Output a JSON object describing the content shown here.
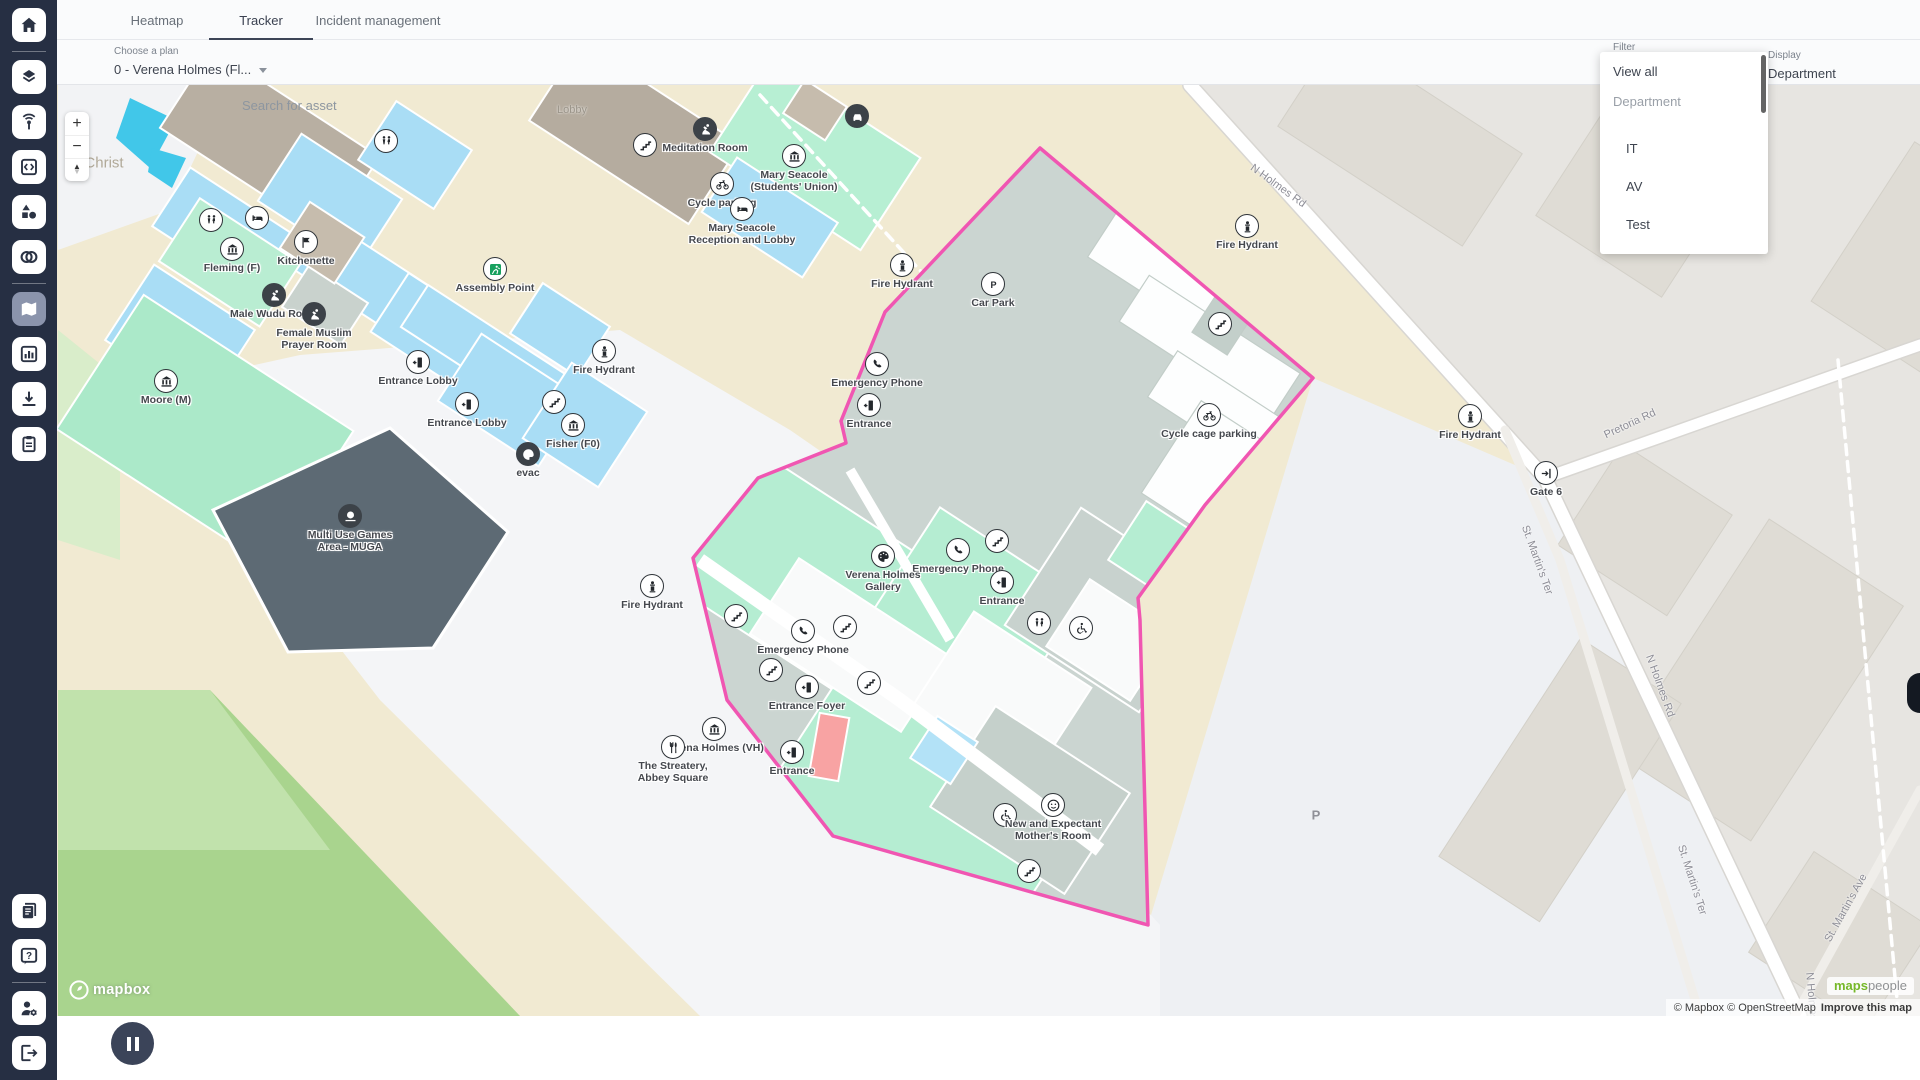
{
  "colors": {
    "accent_pink": "#f056b2",
    "sidebar_bg": "#262f43",
    "active_btn": "#8b94ac",
    "mint": "#b5edd2",
    "room_blue": "#a9ddf5",
    "carpark": "#cbd5d1",
    "grass": "#a9d48e"
  },
  "tabs": [
    {
      "label": "Heatmap",
      "active": false
    },
    {
      "label": "Tracker",
      "active": true
    },
    {
      "label": "Incident management",
      "active": false
    }
  ],
  "toolbar": {
    "plan_label": "Choose a plan",
    "plan_value": "0 - Verena Holmes (Fl...",
    "search_placeholder": "Search for asset",
    "filter_label": "Filter",
    "display_label": "Display",
    "display_value": "Department"
  },
  "filter_menu": {
    "items": [
      {
        "label": "View all",
        "type": "viewall"
      },
      {
        "label": "Department",
        "type": "group"
      },
      {
        "label": "",
        "type": "spacer"
      },
      {
        "label": "IT",
        "type": "item"
      },
      {
        "label": "AV",
        "type": "item"
      },
      {
        "label": "Test",
        "type": "item"
      }
    ]
  },
  "sidebar": {
    "top": [
      {
        "name": "home-icon"
      },
      {
        "name": "divider"
      },
      {
        "name": "layers-icon"
      },
      {
        "name": "beacon-icon"
      },
      {
        "name": "code-icon"
      },
      {
        "name": "shapes-icon"
      },
      {
        "name": "mask-icon"
      },
      {
        "name": "divider"
      },
      {
        "name": "map-icon",
        "active": true
      },
      {
        "name": "chart-icon"
      },
      {
        "name": "download-icon"
      },
      {
        "name": "clipboard-icon"
      }
    ],
    "bottom": [
      {
        "name": "news-icon"
      },
      {
        "name": "help-icon"
      },
      {
        "name": "divider"
      },
      {
        "name": "user-settings-icon"
      },
      {
        "name": "logout-icon"
      }
    ]
  },
  "map": {
    "controls": {
      "zoom_in": "+",
      "zoom_out": "−"
    },
    "area_labels": [
      {
        "label": "Christ",
        "x": 104,
        "y": 163,
        "cls": "area-town"
      },
      {
        "label": "Lobby",
        "x": 572,
        "y": 110,
        "cls": "area-room"
      },
      {
        "label": "P",
        "x": 1316,
        "y": 815,
        "cls": "area-p"
      }
    ],
    "roads": [
      {
        "label": "N Holmes Rd",
        "x": 1278,
        "y": 186,
        "a": 36
      },
      {
        "label": "Pretoria Rd",
        "x": 1630,
        "y": 424,
        "a": -25
      },
      {
        "label": "St. Martin's Ter",
        "x": 1537,
        "y": 560,
        "a": 70
      },
      {
        "label": "N Holmes Rd",
        "x": 1660,
        "y": 686,
        "a": 70
      },
      {
        "label": "St. Martin's Ter",
        "x": 1692,
        "y": 880,
        "a": 72
      },
      {
        "label": "St. Martin's Ave",
        "x": 1846,
        "y": 908,
        "a": -61
      },
      {
        "label": "N Holmes Rd",
        "x": 1812,
        "y": 1005,
        "a": 85
      }
    ],
    "pois": [
      {
        "x": 386,
        "y": 141,
        "icon": "restroom"
      },
      {
        "x": 645,
        "y": 145,
        "icon": "stairs"
      },
      {
        "x": 705,
        "y": 129,
        "icon": "prayer",
        "dark": true,
        "label": "Meditation Room"
      },
      {
        "x": 794,
        "y": 156,
        "icon": "bank",
        "label": "Mary Seacole\n(Students' Union)"
      },
      {
        "x": 857,
        "y": 116,
        "icon": "car",
        "dark": true
      },
      {
        "x": 722,
        "y": 184,
        "icon": "cycle",
        "label": "Cycle parking"
      },
      {
        "x": 742,
        "y": 209,
        "icon": "bed",
        "label": "Mary Seacole\nReception and Lobby"
      },
      {
        "x": 211,
        "y": 220,
        "icon": "restroom"
      },
      {
        "x": 257,
        "y": 218,
        "icon": "bed"
      },
      {
        "x": 232,
        "y": 249,
        "icon": "bank",
        "label": "Fleming (F)"
      },
      {
        "x": 306,
        "y": 242,
        "icon": "flag",
        "label": "Kitchenette"
      },
      {
        "x": 274,
        "y": 295,
        "icon": "prayer",
        "dark": true,
        "label": "Male Wudu Room"
      },
      {
        "x": 314,
        "y": 314,
        "icon": "prayer",
        "dark": true,
        "label": "Female Muslim\nPrayer Room"
      },
      {
        "x": 166,
        "y": 381,
        "icon": "bank",
        "label": "Moore (M)"
      },
      {
        "x": 495,
        "y": 269,
        "icon": "assembly",
        "label": "Assembly Point"
      },
      {
        "x": 418,
        "y": 362,
        "icon": "door",
        "label": "Entrance Lobby"
      },
      {
        "x": 467,
        "y": 404,
        "icon": "door",
        "label": "Entrance Lobby"
      },
      {
        "x": 554,
        "y": 402,
        "icon": "stairs"
      },
      {
        "x": 573,
        "y": 425,
        "icon": "bank",
        "label": "Fisher (F0)"
      },
      {
        "x": 528,
        "y": 454,
        "icon": "palette",
        "dark": true,
        "label": "evac"
      },
      {
        "x": 604,
        "y": 351,
        "icon": "hydrant",
        "label": "Fire Hydrant"
      },
      {
        "x": 902,
        "y": 265,
        "icon": "hydrant",
        "label": "Fire Hydrant"
      },
      {
        "x": 1247,
        "y": 226,
        "icon": "hydrant",
        "label": "Fire Hydrant"
      },
      {
        "x": 1470,
        "y": 416,
        "icon": "hydrant",
        "label": "Fire Hydrant"
      },
      {
        "x": 652,
        "y": 586,
        "icon": "hydrant",
        "label": "Fire Hydrant"
      },
      {
        "x": 877,
        "y": 364,
        "icon": "phone",
        "label": "Emergency Phone"
      },
      {
        "x": 869,
        "y": 405,
        "icon": "door",
        "label": "Entrance"
      },
      {
        "x": 993,
        "y": 284,
        "icon": "parking",
        "label": "Car Park"
      },
      {
        "x": 1220,
        "y": 324,
        "icon": "stairs"
      },
      {
        "x": 1209,
        "y": 415,
        "icon": "cycle",
        "label": "Cycle cage parking"
      },
      {
        "x": 997,
        "y": 541,
        "icon": "stairs"
      },
      {
        "x": 958,
        "y": 550,
        "icon": "phone",
        "label": "Emergency Phone"
      },
      {
        "x": 1002,
        "y": 582,
        "icon": "door",
        "label": "Entrance"
      },
      {
        "x": 1039,
        "y": 623,
        "icon": "restroom"
      },
      {
        "x": 1081,
        "y": 628,
        "icon": "wheelchair"
      },
      {
        "x": 883,
        "y": 556,
        "icon": "palette",
        "label": "Verena Holmes\nGallery"
      },
      {
        "x": 803,
        "y": 631,
        "icon": "phone",
        "label": "Emergency Phone"
      },
      {
        "x": 736,
        "y": 616,
        "icon": "stairs"
      },
      {
        "x": 771,
        "y": 670,
        "icon": "stairs"
      },
      {
        "x": 845,
        "y": 627,
        "icon": "stairs"
      },
      {
        "x": 869,
        "y": 683,
        "icon": "stairs"
      },
      {
        "x": 807,
        "y": 687,
        "icon": "door",
        "label": "Entrance Foyer"
      },
      {
        "x": 714,
        "y": 729,
        "icon": "bank",
        "label": "Verena Holmes (VH)"
      },
      {
        "x": 673,
        "y": 747,
        "icon": "fork",
        "label": "The Streatery,\nAbbey Square"
      },
      {
        "x": 792,
        "y": 752,
        "icon": "door",
        "label": "Entrance"
      },
      {
        "x": 1005,
        "y": 815,
        "icon": "wheelchair"
      },
      {
        "x": 1053,
        "y": 805,
        "icon": "smiley",
        "label": "New and Expectant\nMother's Room"
      },
      {
        "x": 1029,
        "y": 871,
        "icon": "stairs"
      },
      {
        "x": 350,
        "y": 516,
        "icon": "basketball",
        "dark": true,
        "label": "Multi Use Games\nArea - MUGA"
      },
      {
        "x": 1546,
        "y": 473,
        "icon": "gate",
        "label": "Gate 6"
      }
    ],
    "attribution": {
      "mapbox": "© Mapbox",
      "osm": "© OpenStreetMap",
      "improve": "Improve this map"
    },
    "logos": {
      "mapbox": "mapbox",
      "maps": "maps",
      "people": "people"
    }
  },
  "playback": {
    "preset": "Today",
    "datetime": "14 October 2025 17:55",
    "timezone": "Europe/London",
    "progress_pct": 100
  }
}
